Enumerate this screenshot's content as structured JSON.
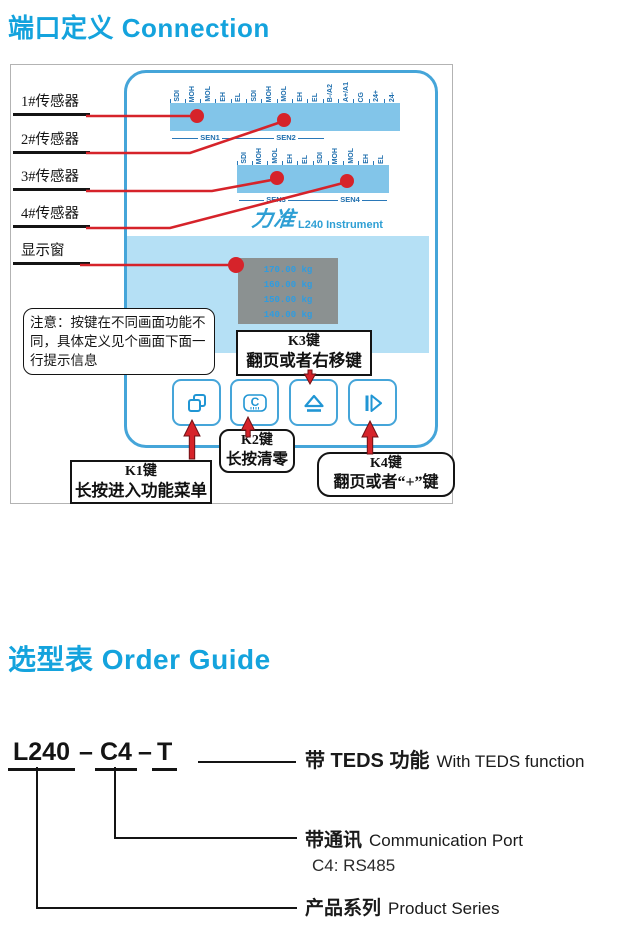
{
  "page": {
    "section1_title": "端口定义 Connection",
    "section2_title": "选型表 Order Guide"
  },
  "colors": {
    "accent_cyan": "#14a3dd",
    "device_blue": "#45a5d9",
    "terminal_bar_blue": "#82c5e9",
    "display_band_blue": "#b5e0f5",
    "terminal_text_blue": "#1f6fae",
    "lcd_gray": "#8b9191",
    "lcd_text_blue": "#2f9ce0",
    "pointer_red": "#d6232a",
    "text_black": "#141414"
  },
  "diagram": {
    "sensor_labels": [
      "1#传感器",
      "2#传感器",
      "3#传感器",
      "4#传感器",
      "显示窗"
    ],
    "terminal_row1": [
      "SDI",
      "MOH",
      "MOL",
      "EH",
      "EL",
      "SDI",
      "MOH",
      "MOL",
      "EH",
      "EL",
      "B-/A2",
      "A+/A1",
      "CG",
      "24+",
      "24-"
    ],
    "terminal_row2": [
      "SDI",
      "MOH",
      "MOL",
      "EH",
      "EL",
      "SDI",
      "MOH",
      "MOL",
      "EH",
      "EL"
    ],
    "sen_row1": [
      "SEN1",
      "SEN2"
    ],
    "sen_row2": [
      "SEN3",
      "SEN4"
    ],
    "brand_logo": "力准",
    "device_name": "L240 Instrument",
    "display_lines": [
      "170.00 kg",
      "160.00 kg",
      "150.00 kg",
      "140.00 kg"
    ],
    "note": "注意：按键在不同画面功能不同，具体定义见个画面下面一行提示信息",
    "keys": {
      "k1": {
        "title": "K1键",
        "desc": "长按进入功能菜单"
      },
      "k2": {
        "title": "K2键",
        "desc": "长按清零"
      },
      "k3": {
        "title": "K3键",
        "desc": "翻页或者右移键"
      },
      "k4": {
        "title": "K4键",
        "desc": "翻页或者“+”键"
      }
    },
    "button_icons": {
      "b1": "pages-menu-icon",
      "b2": "clear-zero-icon",
      "b3": "eject-up-icon",
      "b4": "step-right-icon"
    }
  },
  "order_guide": {
    "code_parts": [
      "L240",
      "C4",
      "T"
    ],
    "dash": "–",
    "features": [
      {
        "zh": "带 TEDS 功能",
        "en": "With TEDS function"
      },
      {
        "zh": "带通讯",
        "en": "Communication Port"
      },
      {
        "zh": "产品系列",
        "en": "Product Series"
      }
    ],
    "c4_note": "C4: RS485"
  }
}
